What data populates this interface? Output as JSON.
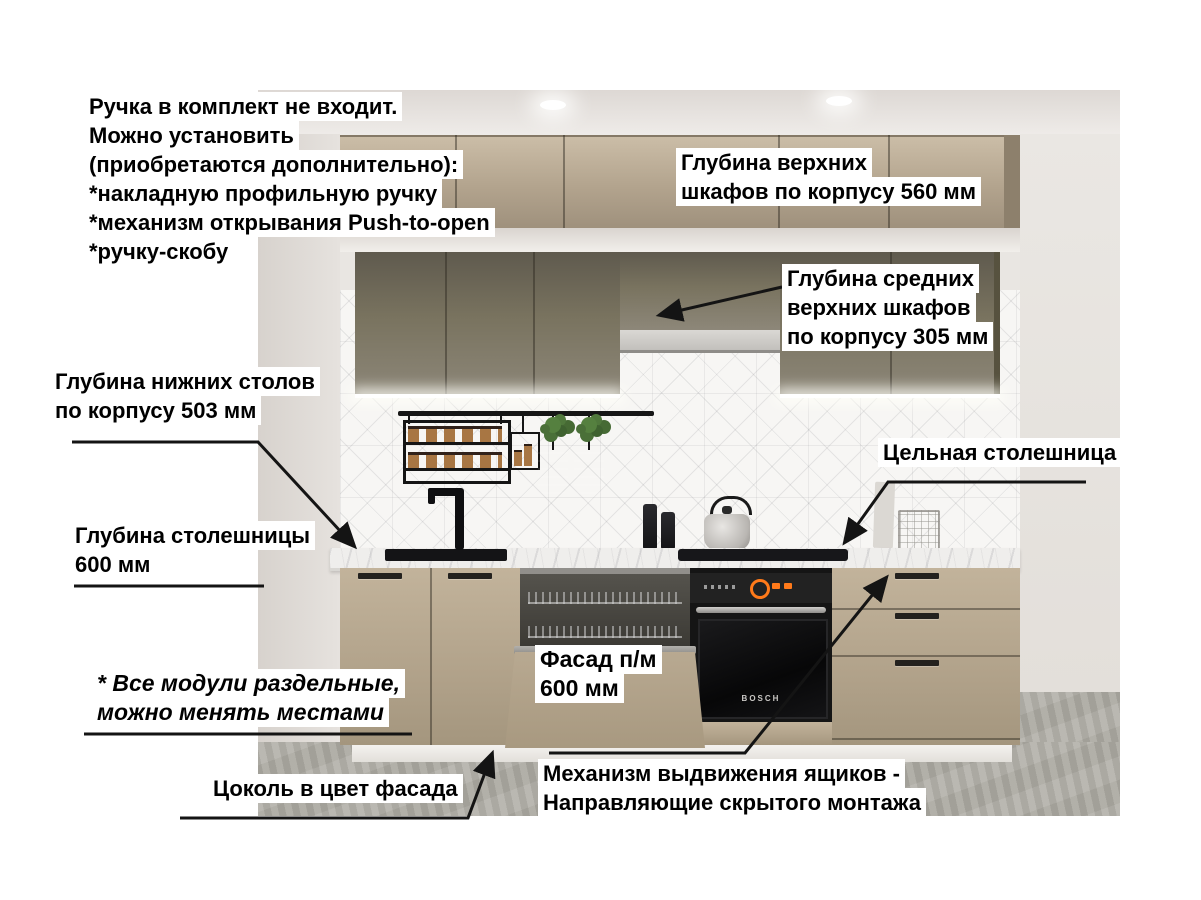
{
  "annotations": {
    "handle_note": {
      "lines": [
        "Ручка в комплект не входит.",
        "Можно установить",
        "(приобретаются дополнительно):",
        "*накладную профильную ручку",
        "*механизм открывания Push-to-open",
        "*ручку-скобу"
      ]
    },
    "upper_cabinet_depth": {
      "lines": [
        "Глубина верхних",
        "шкафов по корпусу 560 мм"
      ]
    },
    "middle_upper_cabinet_depth": {
      "lines": [
        "Глубина средних",
        "верхних шкафов",
        "по корпусу 305 мм"
      ]
    },
    "base_cabinet_depth": {
      "lines": [
        "Глубина нижних столов",
        "по корпусу 503 мм"
      ]
    },
    "countertop_depth": {
      "lines": [
        "Глубина столешницы",
        "600 мм"
      ]
    },
    "solid_countertop": {
      "label": "Цельная столешница"
    },
    "dishwasher_facade": {
      "lines": [
        "Фасад п/м",
        "600 мм"
      ]
    },
    "modules_note": {
      "lines": [
        "* Все модули раздельные,",
        "можно менять местами"
      ]
    },
    "plinth_note": {
      "label": "Цоколь в цвет фасада"
    },
    "drawer_mechanism": {
      "lines": [
        "Механизм выдвижения ящиков -",
        "Направляющие скрытого монтажа"
      ]
    }
  },
  "scene": {
    "oven_brand": "BOSCH",
    "colors": {
      "upper_cabinet_beige": "#b2a38d",
      "middle_cabinet_gray": "#79735f",
      "base_cabinet_beige": "#b1a28a",
      "countertop_marble": "#efeeec",
      "floor_concrete": "#aeaca4",
      "annotation_text": "#000000",
      "annotation_background": "#ffffff",
      "arrow_color": "#141414"
    }
  }
}
